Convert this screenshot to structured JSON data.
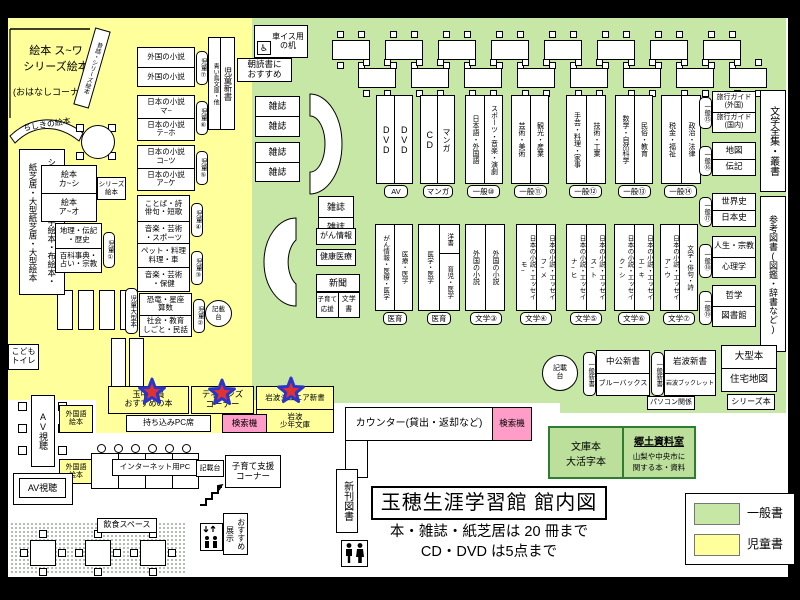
{
  "colors": {
    "children_zone": "#ffff9c",
    "general_zone": "#c6e7a5",
    "search_pink": "#ff9cc8",
    "local_room_green": "#bcdf9c",
    "star_red": "#e03232",
    "star_blue": "#2b35c8"
  },
  "titleblock": {
    "heading": "玉穂生涯学習館 館内図",
    "rule1": "本・雑誌・紙芝居は 20 冊まで",
    "rule2": "CD・DVD は5点まで"
  },
  "legend": {
    "general": "一般書",
    "children": "児童書"
  },
  "children": {
    "storytime_line1": "絵本 ス~ワ",
    "storytime_line2": "シリーズ絵本",
    "storytime_note": "(おはなしコーナー)",
    "diagonal_shelf": "昔話・シリーズ絵本",
    "curved_shelf": "ちしきの絵本",
    "tall_shelf": "シリーズ本・点字絵本・布絵本・\n紙芝居・大型紙芝居・大型絵本",
    "picture_books": {
      "rows": [
        "絵本\nカ~シ",
        "絵本\nア~オ"
      ],
      "side": "シリーズ\n絵本"
    },
    "shelves": [
      {
        "rows": [
          "外国の小説",
          "外国の小説"
        ],
        "badge": "児童⑦"
      },
      {
        "rows": [
          "日本の小説\nマ~",
          "日本の小説\nテ~ホ"
        ],
        "badge": "児童⑥"
      },
      {
        "rows": [
          "日本の小説\nコ~ツ",
          "日本の小説\nア~ケ"
        ],
        "badge": "児童⑤"
      },
      {
        "rows": [
          "ことば・詩\n俳句・短歌",
          "音楽・芸術\n・スポーツ"
        ],
        "badge": "児童④"
      },
      {
        "rows": [
          "ペット・料理\n料理・車",
          "音楽・芸術\n・保健"
        ],
        "badge": "児童③"
      },
      {
        "rows": [
          "恐竜・星座\n算数",
          "社会・教育\nしごと・民話"
        ],
        "badge": "児童②"
      },
      {
        "rows": [
          "地理・伝記\n・歴史",
          "百科事典・\n占い・宗教"
        ],
        "badge": "児童①"
      }
    ],
    "large_books_tag": "児童大型本",
    "aoitori_left": "青い鳥文庫・他",
    "aoitori_right": "児童新書",
    "magazines": [
      "雑誌",
      "雑誌",
      "雑誌",
      "雑誌"
    ],
    "kids_toilet": "こども\nトイレ",
    "foreign_picture_books": "外国語\n絵本"
  },
  "teens": {
    "recommend_box": "玉中職員\nおすすめの本",
    "teens_corner": "ティーンズ\nコーナー",
    "iwanami_junior": "岩波ジュニア新書",
    "iwanami_shonen": "岩波\n少年文庫",
    "byod_pc": "持ち込みPC席",
    "search_kiosk": "検索機"
  },
  "general": {
    "top_shelves": [
      {
        "cols": [
          "DVD",
          "DVD"
        ],
        "tag": "AV"
      },
      {
        "cols": [
          "CD",
          "マンガ"
        ],
        "tag": "マンガ"
      },
      {
        "cols": [
          "日本語・外国語",
          "スポーツ・音楽・演劇"
        ],
        "tag": "一般⑩"
      },
      {
        "cols": [
          "芸術・美術",
          "観光・産業"
        ],
        "tag": "一般⑪"
      },
      {
        "cols": [
          "手芸・料理・家事",
          "技術・工業"
        ],
        "tag": "一般⑫"
      },
      {
        "cols": [
          "数学・自然科学",
          "民俗・教育"
        ],
        "tag": "一般⑬"
      },
      {
        "cols": [
          "税金・福祉",
          "政治・法律"
        ],
        "tag": "一般⑭"
      }
    ],
    "right_shelves": [
      {
        "rows": [
          "旅行ガイド\n(外国)",
          "旅行ガイド\n(国内)"
        ],
        "tag": "一般⑮"
      },
      {
        "rows": [
          "地図",
          "伝記"
        ],
        "tag": "一般⑯"
      },
      {
        "rows": [
          "世界史",
          "日本史"
        ],
        "tag": "一般⑰"
      },
      {
        "rows": [
          "人生・宗教",
          "心理学"
        ],
        "tag": "一般⑱"
      },
      {
        "rows": [
          "哲学",
          "図書館"
        ],
        "tag": "一般⑲"
      }
    ],
    "literature_collection": "文学全集・叢書",
    "reference": "参考図書(図鑑・辞書など)",
    "mid_shelves": [
      {
        "cols": [
          "がん情報・医療・医学",
          "医療・医学"
        ],
        "tag": "医育"
      },
      {
        "cols": [
          "医学・医学"
        ],
        "right_top": "洋書",
        "right_bottom": "育児・医学",
        "tag": "医育"
      },
      {
        "cols": [
          "外国の小説",
          "外国の小説"
        ],
        "tag": "文学③"
      },
      {
        "cols": [
          "日本の小説・エッセイ\nモ~",
          "日本の小説・エッセイ\nフ~メ"
        ],
        "tag": "文学④"
      },
      {
        "cols": [
          "日本の小説・エッセイ\nナ~ヒ",
          "日本の小説・エッセイ\nス~ト"
        ],
        "tag": "文学⑤"
      },
      {
        "cols": [
          "日本の小説・エッセイ\nク~シ",
          "日本の小説・エッセイ\nエ~キ"
        ],
        "tag": "文学⑥"
      },
      {
        "cols": [
          "日本の小説・エッセイ\nア~ウ",
          "文学・俳句・詩"
        ],
        "tag": "文学⑦"
      }
    ],
    "info": {
      "magazines": [
        "雑誌",
        "雑誌"
      ],
      "cancer": "がん情報",
      "health": "健康医療",
      "newspaper": "新聞",
      "kosodate": "子育て\n応援",
      "bungakusho": "文学書"
    },
    "paperbacks": [
      {
        "tag": "一般新書",
        "rows": [
          "中公新書",
          "ブルーバックス"
        ]
      },
      {
        "tag": "一般新書",
        "rows": [
          "岩波新書",
          "岩波ブックレット"
        ]
      }
    ],
    "large_books": {
      "rows": [
        "大型本",
        "住宅地図"
      ]
    },
    "pc_related": "パソコン関係",
    "series_books": "シリーズ本",
    "bunko": "文庫本\n大活字本",
    "local": {
      "heading": "郷土資料室",
      "desc": "山梨や中央市に\n関する本・資料"
    }
  },
  "facilities": {
    "counter": "カウンター(貸出・返却など)",
    "search_kiosk": "検索機",
    "new_books": "新刊図書",
    "av_table": "AV視聴",
    "av_booth": "AV視聴",
    "dining": "飲食スペース",
    "internet_pc": "インターネット用PC",
    "writing_desk": "記載\n台",
    "writing_desk_flat": "記載台",
    "kosodate_corner": "子育て支援\nコーナー",
    "osusume_tenji": "おすすめ\n展示",
    "wheelchair_desk": "車イス用\nの机",
    "wheelchair_icon": "♿",
    "asadoku": "朝読書に\nおすすめ"
  }
}
